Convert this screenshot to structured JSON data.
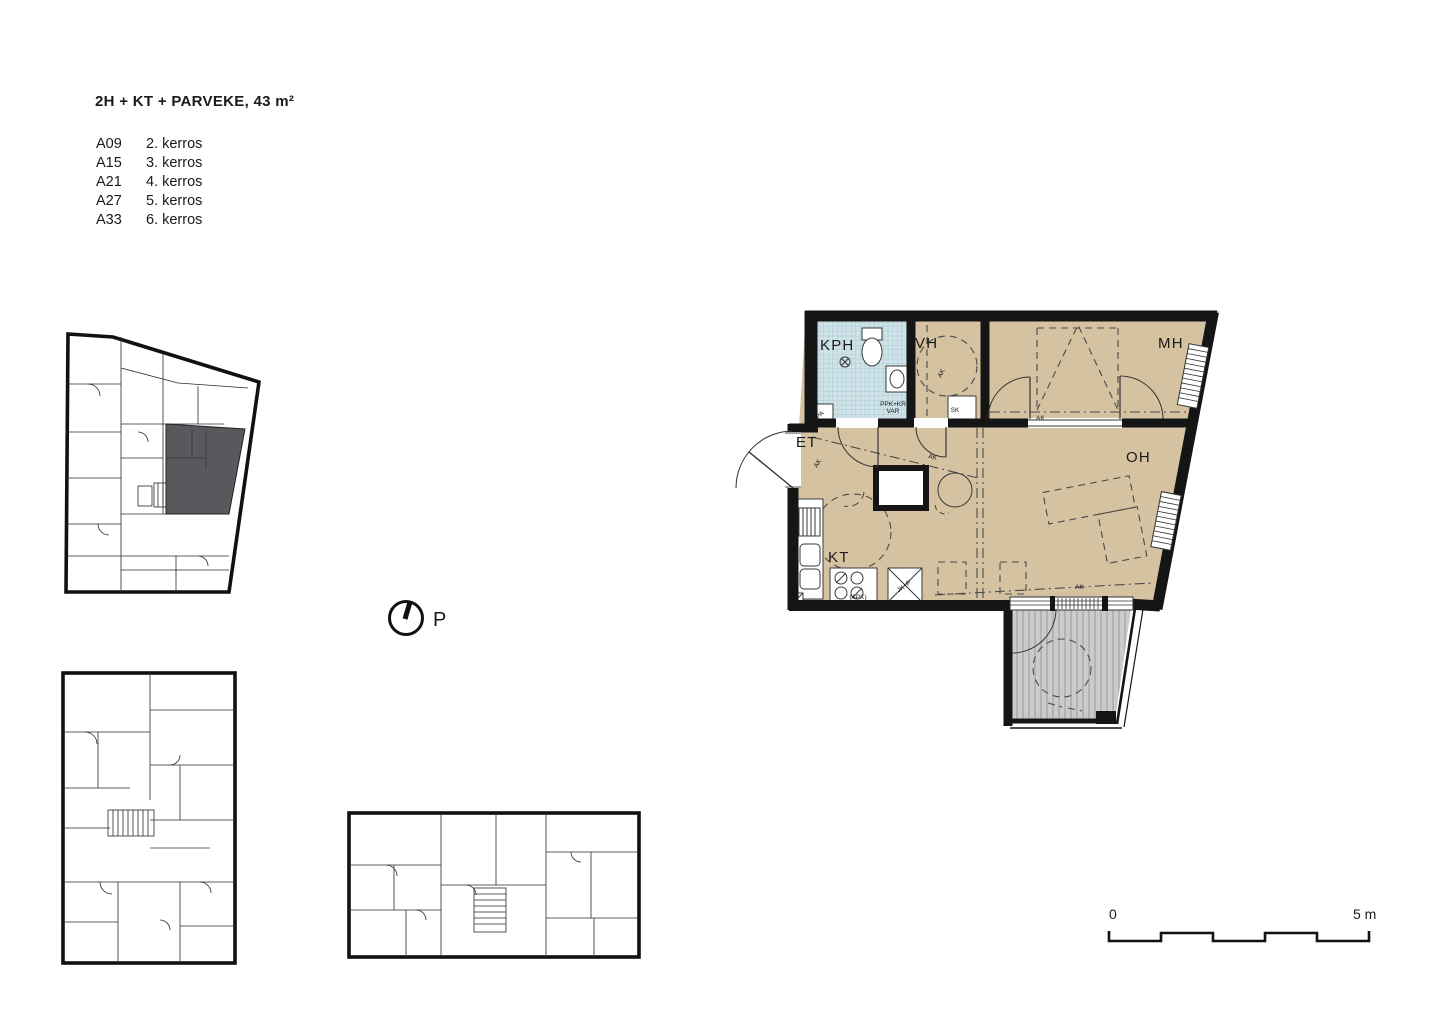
{
  "header": {
    "title": "2H + KT + PARVEKE, 43 m²"
  },
  "units": [
    {
      "code": "A09",
      "floor": "2. kerros"
    },
    {
      "code": "A15",
      "floor": "3. kerros"
    },
    {
      "code": "A21",
      "floor": "4. kerros"
    },
    {
      "code": "A27",
      "floor": "5. kerros"
    },
    {
      "code": "A33",
      "floor": "6. kerros"
    }
  ],
  "north_arrow": {
    "label": "P"
  },
  "scale_bar": {
    "start": "0",
    "end": "5 m"
  },
  "main_plan": {
    "labels": {
      "kph": "KPH",
      "vh": "VH",
      "mh": "MH",
      "et": "ET",
      "oh": "OH",
      "kt": "KT",
      "sk": "SK",
      "ppk_line1": "PPK+KR",
      "ppk_line2": "VAR",
      "pa": "PA",
      "apk": "(APK)",
      "jkp": "JK+P",
      "ak": "AK"
    },
    "colors": {
      "floor_tan": "#d5c2a0",
      "tile_blue": "#cfe3e8",
      "balcony_gray": "#cbcbcb",
      "wall_black": "#151515",
      "highlight_gray": "#58595d"
    }
  }
}
